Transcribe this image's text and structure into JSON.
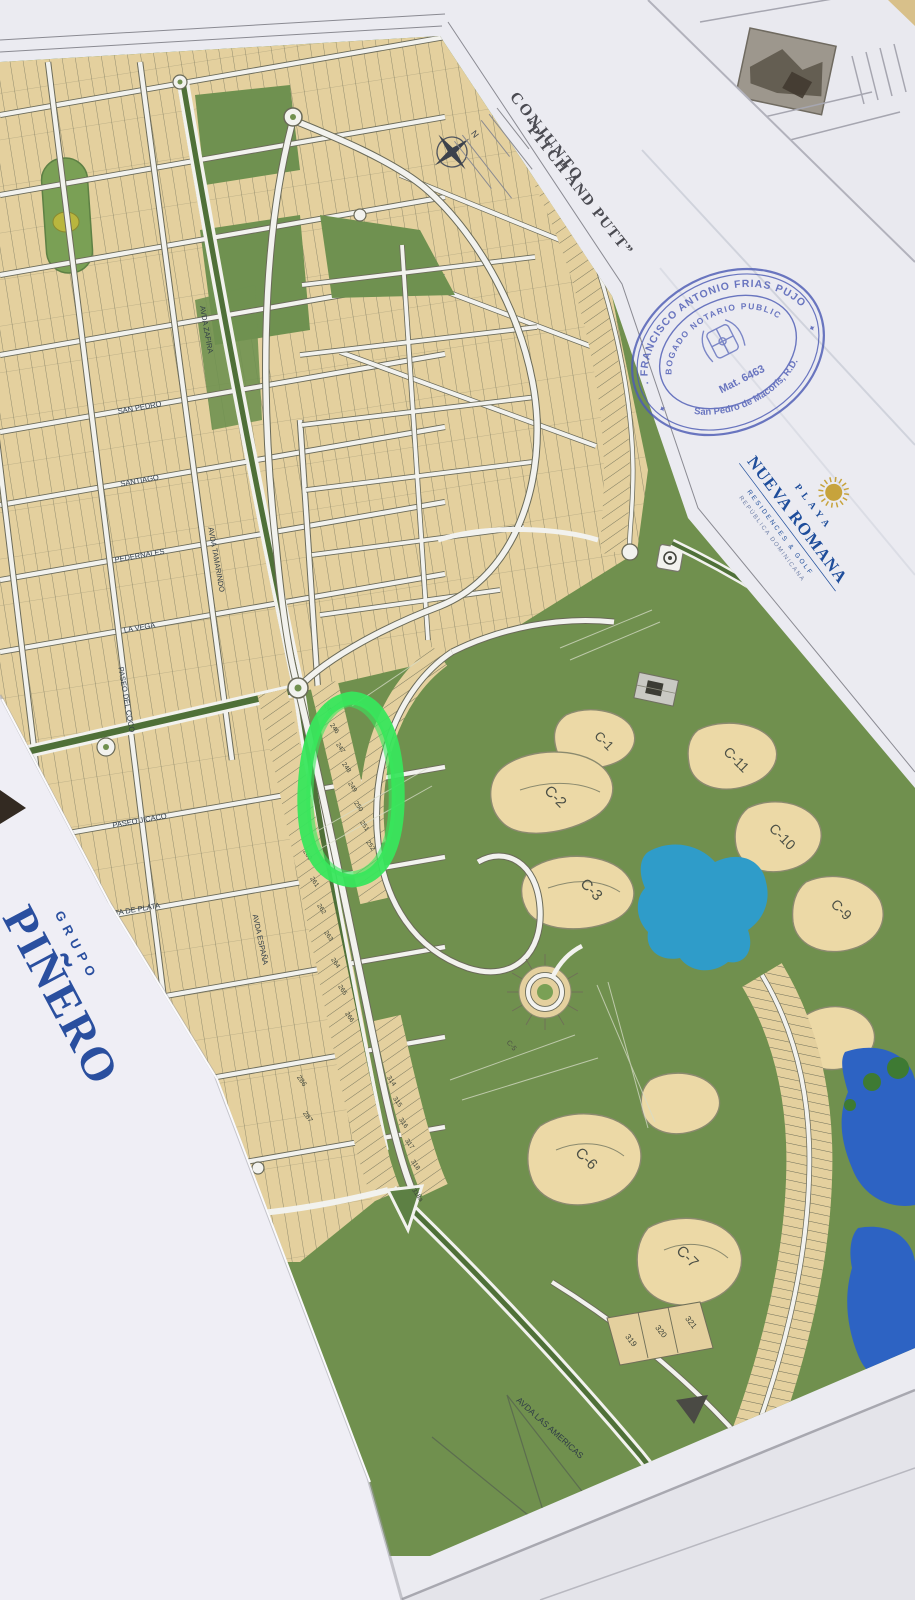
{
  "title_block": {
    "project_line1": "CONJUNTO",
    "project_line2": "“PITCH AND PUTT”",
    "north_label": "N"
  },
  "notary_stamp": {
    "name": "DR. FRANCISCO ANTONIO FRIAS PUJOLS",
    "role": "ABOGADO NOTARIO PUBLICO",
    "registration": "Mat. 6463",
    "city": "San Pedro de Macorís, R.D.",
    "ink_color": "#4d5cb5"
  },
  "brand_logo": {
    "top": "PLAYA",
    "name": "NUEVA ROMANA",
    "tagline": "RESIDENCES & GOLF",
    "country": "REPÚBLICA DOMINICANA",
    "text_color": "#1e4d9b",
    "sun_color": "#c7a33c"
  },
  "corner_sheet": {
    "small": "GRUPO",
    "large": "PIÑERO",
    "text_color": "#2a4f9f"
  },
  "map": {
    "street_labels": [
      "SAN PEDRO",
      "SANTIAGO",
      "PEDERNALES",
      "LA VEGA",
      "PASEO JICACO",
      "PUNTA DE PLATA",
      "AVDA ESPAÑA",
      "AVDA TAMARINDO",
      "AVDA ZAFIRA",
      "PASEO DEL COCO",
      "AVDA LAS AMERICAS"
    ],
    "golf_hole_labels": [
      "C-1",
      "C-2",
      "C-3",
      "C-5",
      "C-6",
      "C-7",
      "C-9",
      "C-10",
      "C-11"
    ],
    "lot_numbers": {
      "avenue_east": [
        245,
        246,
        247,
        248,
        249,
        250,
        251,
        252
      ],
      "avenue_west": [
        260,
        261,
        262,
        263,
        264,
        265,
        266
      ],
      "block_pair": [
        286,
        287
      ],
      "south_strip": [
        314,
        315,
        316,
        317,
        318
      ],
      "south_strip_last": "318a",
      "corner_block": [
        319,
        320,
        321
      ]
    },
    "annotation": {
      "shape": "hand-drawn ellipse",
      "color": "#38e65c"
    },
    "colors": {
      "greens": "#70904e",
      "lots": "#e4d09e",
      "water_pond": "#2f9cc9",
      "water_lake": "#2d63c3",
      "roads": "#f2f2ee"
    }
  }
}
